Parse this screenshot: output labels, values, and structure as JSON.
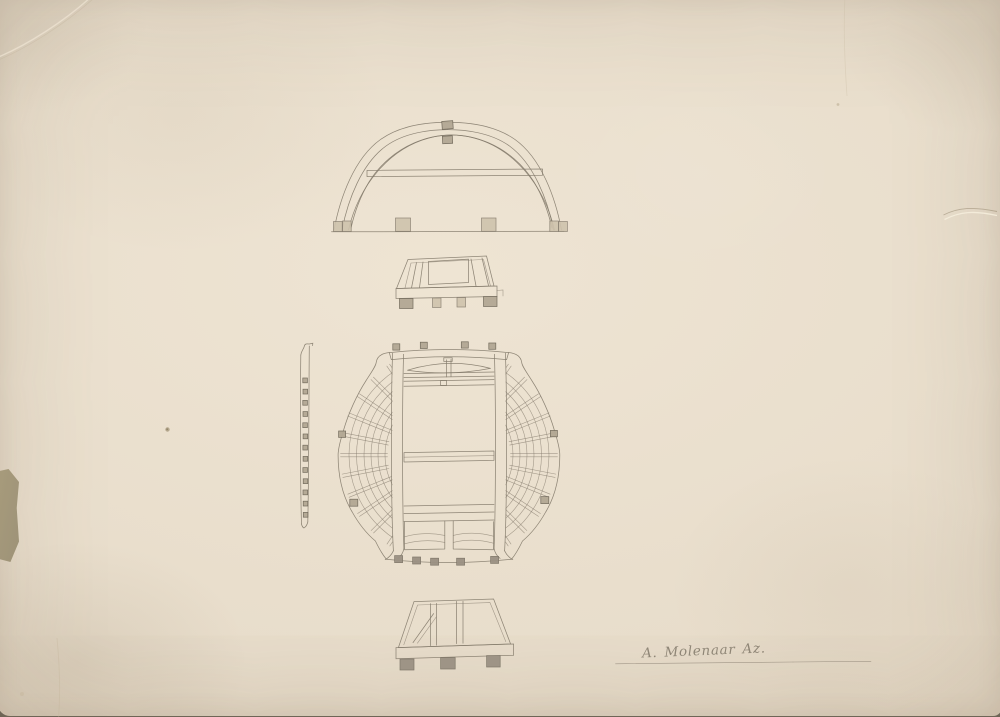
{
  "scan": {
    "signature": {
      "text": "A. Molenaar Az."
    },
    "colors": {
      "backing": "#6e6556",
      "paper": "#e8ddcb",
      "paper_light": "#eee4d3",
      "paper_edge": "#d5c7af",
      "patch": "#a49878",
      "ink": "#847b6c",
      "ink_dark": "#6d6557",
      "block_light": "#cfc3ad",
      "block_mid": "#b3a894",
      "block_dark": "#9b9183"
    },
    "views": [
      {
        "name": "arch-cross-section"
      },
      {
        "name": "upper-base-frame-elevation"
      },
      {
        "name": "side-profile-strip"
      },
      {
        "name": "circular-plan"
      },
      {
        "name": "lower-base-frame-elevation"
      }
    ]
  }
}
